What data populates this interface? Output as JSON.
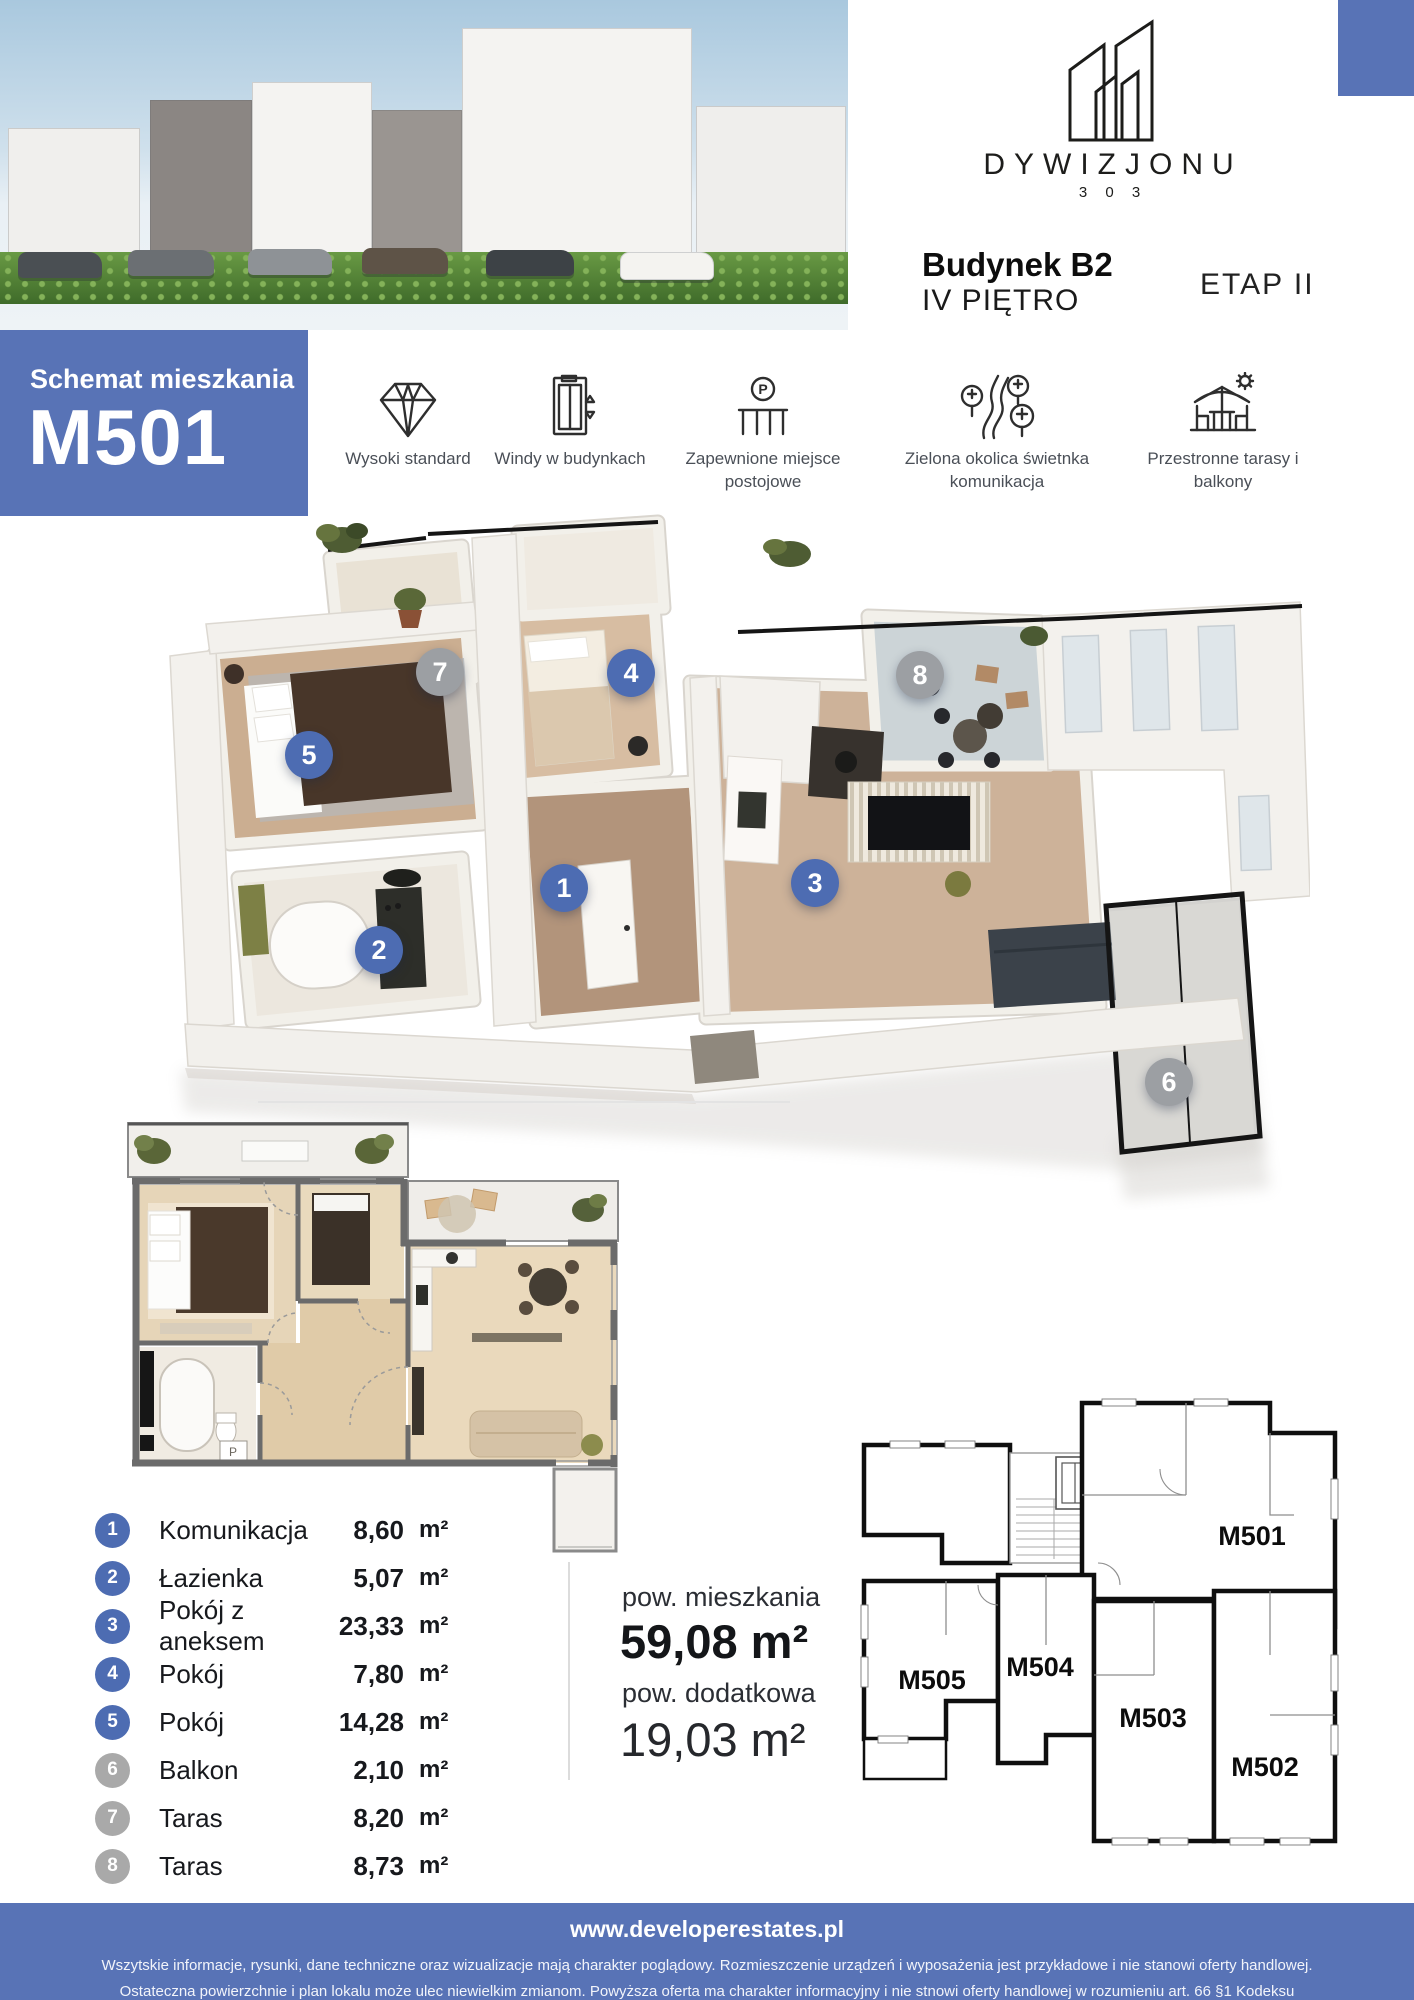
{
  "brand": {
    "logo_name": "DYWIZJONU",
    "logo_number": "3 0 3"
  },
  "header": {
    "building": "Budynek B2",
    "floor": "IV PIĘTRO",
    "stage": "ETAP II"
  },
  "schematic": {
    "label": "Schemat mieszkania",
    "unit": "M501"
  },
  "features": [
    {
      "icon": "diamond-icon",
      "label": "Wysoki standard"
    },
    {
      "icon": "elevator-icon",
      "label": "Windy w budynkach"
    },
    {
      "icon": "parking-icon",
      "label": "Zapewnione miejsce postojowe"
    },
    {
      "icon": "nature-road-icon",
      "label": "Zielona okolica świetnka komunikacja"
    },
    {
      "icon": "terrace-icon",
      "label": "Przestronne tarasy i balkony"
    }
  ],
  "rooms": [
    {
      "no": "1",
      "name": "Komunikacja",
      "area": "8,60",
      "unit": "m²",
      "type": "main"
    },
    {
      "no": "2",
      "name": "Łazienka",
      "area": "5,07",
      "unit": "m²",
      "type": "main"
    },
    {
      "no": "3",
      "name": "Pokój z aneksem",
      "area": "23,33",
      "unit": "m²",
      "type": "main"
    },
    {
      "no": "4",
      "name": "Pokój",
      "area": "7,80",
      "unit": "m²",
      "type": "main"
    },
    {
      "no": "5",
      "name": "Pokój",
      "area": "14,28",
      "unit": "m²",
      "type": "main"
    },
    {
      "no": "6",
      "name": "Balkon",
      "area": "2,10",
      "unit": "m²",
      "type": "extra"
    },
    {
      "no": "7",
      "name": "Taras",
      "area": "8,20",
      "unit": "m²",
      "type": "extra"
    },
    {
      "no": "8",
      "name": "Taras",
      "area": "8,73",
      "unit": "m²",
      "type": "extra"
    }
  ],
  "summary": {
    "main_area_label": "pow. mieszkania",
    "main_area_value": "59,08 m²",
    "extra_area_label": "pow. dodatkowa",
    "extra_area_value": "19,03 m²"
  },
  "floor_overview": {
    "units": [
      "M501",
      "M502",
      "M503",
      "M504",
      "M505"
    ]
  },
  "plan_2d": {
    "washer_label": "P"
  },
  "footer": {
    "website": "www.developerestates.pl",
    "disclaimer_line1": "Wszytskie informacje, rysunki, dane techniczne oraz wizualizacje mają charakter poglądowy. Rozmieszczenie urządzeń i wyposażenia jest przykładowe i nie stanowi oferty handlowej.",
    "disclaimer_line2": "Ostateczna powierzchnie i plan lokalu może ulec niewielkim zmianom. Powyższa oferta ma charakter informacyjny i nie stnowi oferty handlowej w rozumieniu art. 66 §1 Kodeksu"
  },
  "colors": {
    "accent": "#5873b6",
    "marker_blue": "#4d6cb2",
    "marker_gray": "#9c9fa3"
  }
}
